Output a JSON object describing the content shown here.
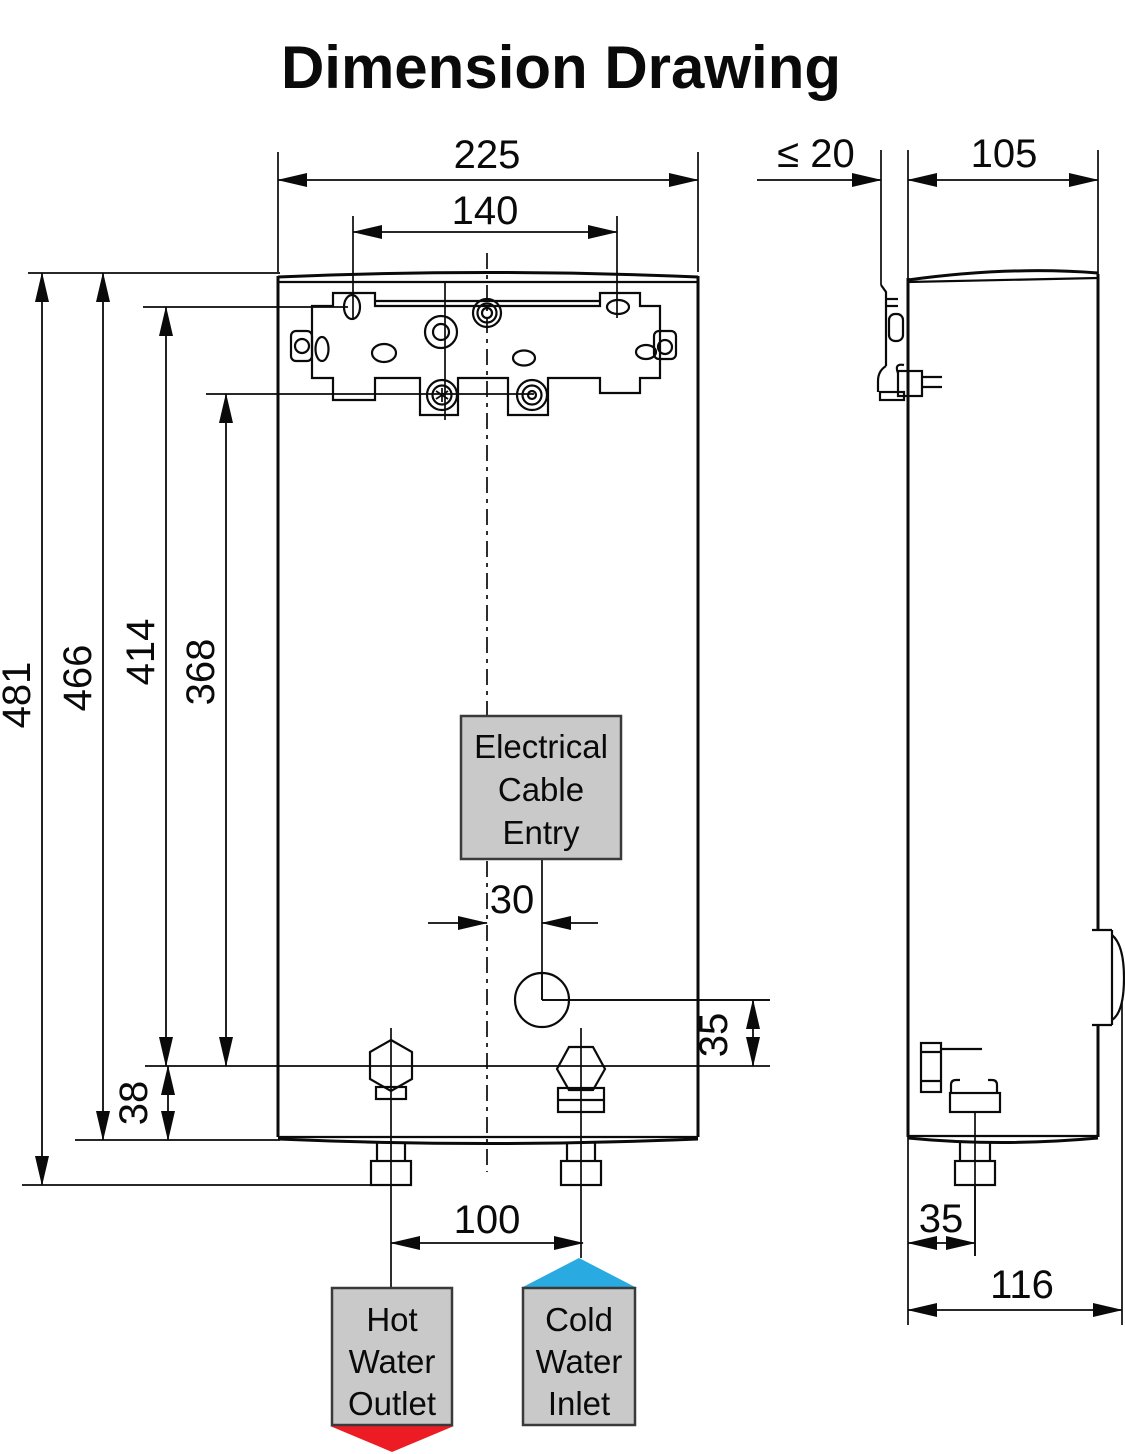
{
  "title": "Dimension Drawing",
  "front_view": {
    "width": "225",
    "mounting_hole_spacing": "140",
    "overall_height": "481",
    "body_height": "466",
    "upper_mount_height": "414",
    "lower_mount_height": "368",
    "connection_offset": "38",
    "cable_entry_offset": "30",
    "cable_entry_height": "35",
    "pipe_spacing": "100",
    "cable_entry_label": {
      "line1": "Electrical",
      "line2": "Cable",
      "line3": "Entry"
    },
    "hot_outlet_label": {
      "line1": "Hot",
      "line2": "Water",
      "line3": "Outlet"
    },
    "cold_inlet_label": {
      "line1": "Cold",
      "line2": "Water",
      "line3": "Inlet"
    }
  },
  "side_view": {
    "wall_clearance": "≤ 20",
    "body_depth": "105",
    "pipe_offset": "35",
    "overall_depth": "116"
  },
  "colors": {
    "hot_arrow": "#ED1C24",
    "cold_arrow": "#29ABE2",
    "label_box_fill": "#C9C9C9",
    "line_color": "#0A0A0A"
  }
}
